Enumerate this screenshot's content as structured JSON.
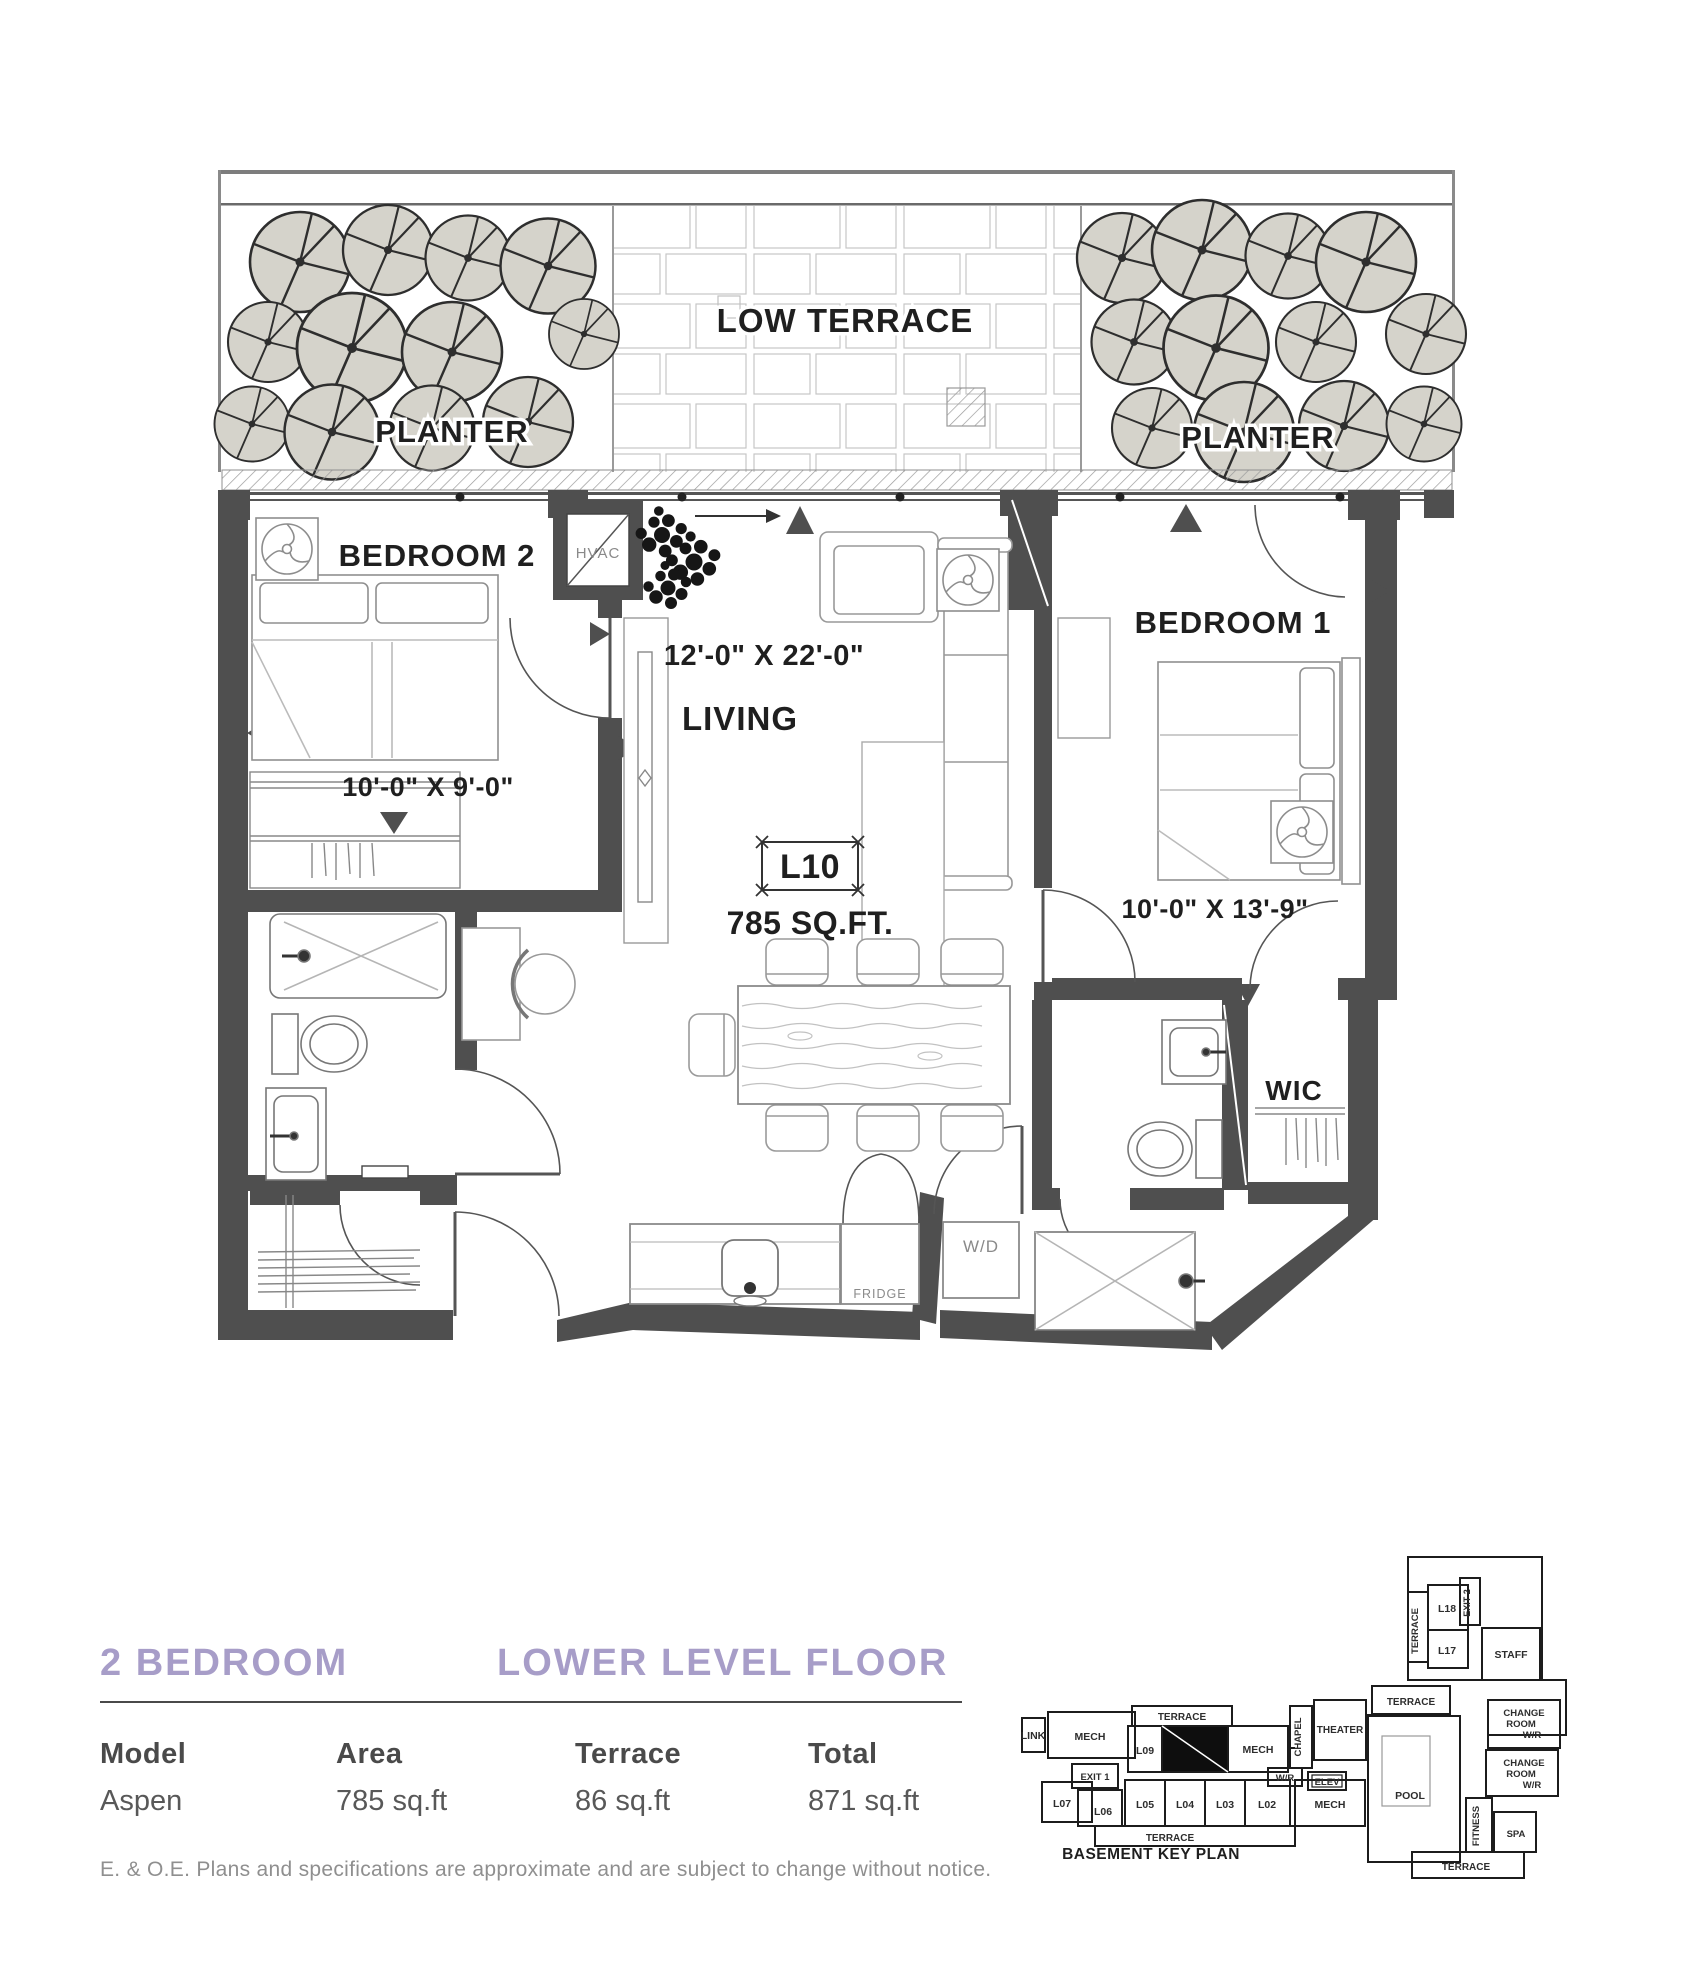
{
  "colors": {
    "accent": "#a79dc8",
    "wall": "#4f4f4f",
    "ink": "#1f1f1f",
    "muted": "#8a8a8a",
    "foliage": "#d5d3cb"
  },
  "plan": {
    "terrace": {
      "low_terrace_label": "LOW TERRACE",
      "planter_left_label": "PLANTER",
      "planter_right_label": "PLANTER"
    },
    "unit_tag": {
      "code": "L10",
      "area": "785 SQ.FT."
    },
    "rooms": {
      "bedroom2": {
        "label": "BEDROOM 2",
        "dim": "10'-0\" X 9'-0\""
      },
      "living": {
        "label": "LIVING",
        "dim": "12'-0\" X 22'-0\""
      },
      "bedroom1": {
        "label": "BEDROOM 1",
        "dim": "10'-0\" X 13'-9\""
      },
      "wic_label": "WIC",
      "hvac_label": "HVAC",
      "fridge_label": "FRIDGE",
      "wd_label": "W/D"
    }
  },
  "info": {
    "unit_type": "2 BEDROOM",
    "level": "LOWER LEVEL FLOOR",
    "columns": [
      {
        "label": "Model",
        "value": "Aspen"
      },
      {
        "label": "Area",
        "value": "785 sq.ft"
      },
      {
        "label": "Terrace",
        "value": "86 sq.ft"
      },
      {
        "label": "Total",
        "value": "871 sq.ft"
      }
    ],
    "disclaimer": "E. & O.E. Plans and specifications are approximate and are subject to change without notice."
  },
  "keyplan": {
    "caption": "BASEMENT KEY PLAN",
    "labels": {
      "link": "LINK",
      "mech_left": "MECH",
      "terrace_top": "TERRACE",
      "l09": "L09",
      "mech_mid": "MECH",
      "chapel": "CHAPEL",
      "theater": "THEATER",
      "wr": "W/R",
      "elev": "ELEV",
      "exit1": "EXIT 1",
      "l07": "L07",
      "l06": "L06",
      "l05": "L05",
      "l04": "L04",
      "l03": "L03",
      "l02": "L02",
      "mech_right": "MECH",
      "terrace_bottom": "TERRACE",
      "l18": "L18",
      "exit2": "EXIT 2",
      "l17": "L17",
      "staff": "STAFF",
      "terrace_upper": "TERRACE",
      "terrace_mid": "TERRACE",
      "change": "CHANGE",
      "room": "ROOM",
      "wr2": "W/R",
      "pool": "POOL",
      "fitness": "FITNESS",
      "spa": "SPA",
      "terrace_right": "TERRACE"
    }
  }
}
